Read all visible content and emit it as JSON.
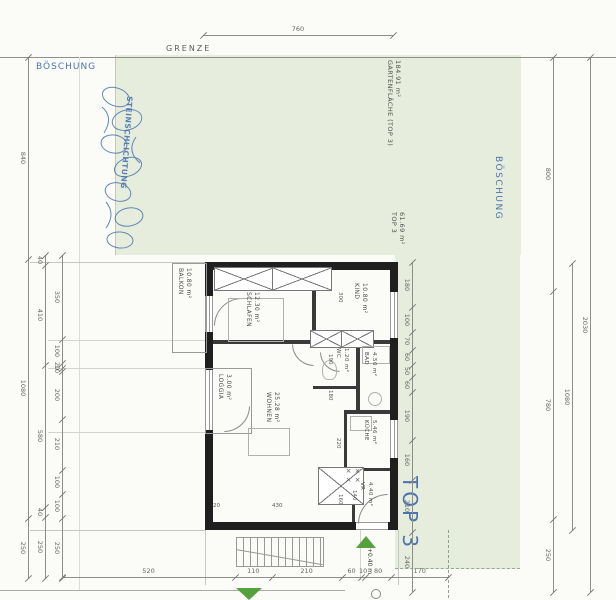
{
  "colors": {
    "garden": "#e6eddc",
    "annotation_blue": "#4a74b0",
    "wall": "#1f1f1f",
    "dimension_gray": "#666666",
    "marker_green": "#55a13c"
  },
  "site": {
    "grenze": "GRENZE",
    "boeschung_left": "BÖSCHUNG",
    "boeschung_right": "BÖSCHUNG",
    "steinschlichtung": "STEINSCHLICHTUNG",
    "garden_label": {
      "name": "GARTENFLÄCHE (TOP 3)",
      "area": "184.91 m²"
    },
    "unit_label": {
      "name": "TOP 3",
      "area": "61.69 m²"
    },
    "unit_big_label": "TOP 3"
  },
  "rooms": {
    "balkon": {
      "name": "BALKON",
      "area": "10.80 m²"
    },
    "schlafen": {
      "name": "SCHLAFEN",
      "area": "12.30 m²"
    },
    "kind": {
      "name": "KIND",
      "area": "10.80 m²"
    },
    "wc": {
      "name": "WC",
      "area": "1.20 m²"
    },
    "bad": {
      "name": "BAD",
      "area": "4.50 m²"
    },
    "kueche": {
      "name": "KÜCHE",
      "area": "5.46 m²"
    },
    "wohnen": {
      "name": "WOHNEN",
      "area": "25.28 m²"
    },
    "loggia": {
      "name": "LOGGIA",
      "area": "3.00 m²"
    },
    "vr": {
      "name": "VR",
      "area": "4.40 m²"
    }
  },
  "levels": {
    "entry_marker": "+0.40 m"
  },
  "dim_chains": [
    {
      "name": "dim-top",
      "o": "h",
      "x1": 203,
      "x2": 393,
      "y": 35,
      "values": [
        760
      ]
    },
    {
      "name": "dim-bottom",
      "o": "h",
      "x1": 62,
      "x2": 448,
      "y": 577,
      "values": [
        520,
        110,
        210,
        60,
        10,
        80,
        170
      ]
    },
    {
      "name": "dim-left-outer",
      "o": "v",
      "x": 28,
      "y1": 57,
      "y2": 578,
      "values": [
        840,
        1080,
        250
      ]
    },
    {
      "name": "dim-left-mid",
      "o": "v",
      "x": 45,
      "y1": 255,
      "y2": 578,
      "values": [
        40,
        410,
        580,
        40,
        250
      ]
    },
    {
      "name": "dim-left-inner",
      "o": "v",
      "x": 62,
      "y1": 255,
      "y2": 578,
      "values": [
        350,
        100,
        20,
        10,
        200,
        210,
        100,
        100,
        250
      ]
    },
    {
      "name": "dim-plan-right",
      "o": "v",
      "x": 412,
      "y1": 262,
      "y2": 592,
      "values": [
        180,
        100,
        70,
        60,
        50,
        60,
        190,
        160,
        210,
        240
      ]
    },
    {
      "name": "dim-page-right-a",
      "o": "v",
      "x": 553,
      "y1": 57,
      "y2": 592,
      "values": [
        800,
        780,
        250
      ]
    },
    {
      "name": "dim-page-right-b",
      "o": "v",
      "x": 572,
      "y1": 263,
      "y2": 530,
      "values": [
        1080
      ]
    },
    {
      "name": "dim-page-right-c",
      "o": "v",
      "x": 590,
      "y1": 57,
      "y2": 592,
      "values": [
        2030
      ]
    }
  ],
  "interior_dims": [
    {
      "v": "300",
      "x": 336,
      "y": 292,
      "o": "v"
    },
    {
      "v": "190",
      "x": 326,
      "y": 354,
      "o": "v"
    },
    {
      "v": "180",
      "x": 326,
      "y": 390,
      "o": "v"
    },
    {
      "v": "220",
      "x": 334,
      "y": 438,
      "o": "v"
    },
    {
      "v": "160",
      "x": 336,
      "y": 494,
      "o": "v"
    },
    {
      "v": "140",
      "x": 350,
      "y": 490,
      "o": "v"
    },
    {
      "v": "430",
      "x": 272,
      "y": 503,
      "o": "h"
    },
    {
      "v": "20",
      "x": 213,
      "y": 503,
      "o": "h"
    }
  ]
}
